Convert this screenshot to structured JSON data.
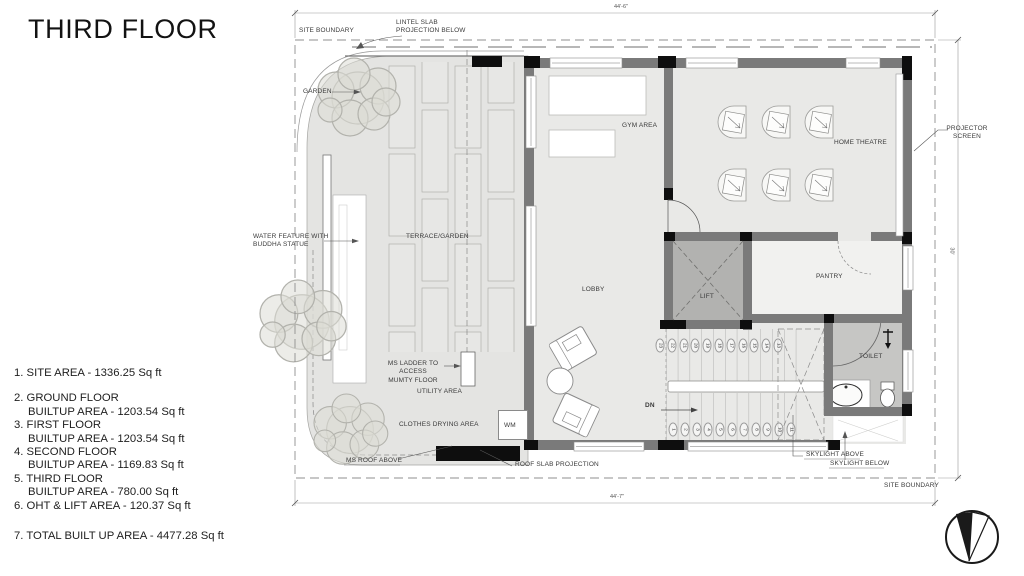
{
  "title": "THIRD FLOOR",
  "area_summary": {
    "items": [
      {
        "line1": "1. SITE AREA -  1336.25 Sq ft",
        "line2": ""
      },
      {
        "line1": "2. GROUND FLOOR",
        "line2": "BUILTUP AREA - 1203.54 Sq ft"
      },
      {
        "line1": "3. FIRST FLOOR",
        "line2": "BUILTUP AREA - 1203.54 Sq ft"
      },
      {
        "line1": "4. SECOND FLOOR",
        "line2": "BUILTUP AREA - 1169.83 Sq ft"
      },
      {
        "line1": "5. THIRD FLOOR",
        "line2": "BUILTUP AREA - 780.00 Sq ft"
      },
      {
        "line1": "6. OHT & LIFT AREA - 120.37 Sq ft",
        "line2": ""
      }
    ],
    "total": "7. TOTAL BUILT UP AREA -  4477.28 Sq ft"
  },
  "rooms": {
    "terrace": "TERRACE/GARDEN",
    "gym": "GYM AREA",
    "home_theatre": "HOME THEATRE",
    "lobby": "LOBBY",
    "lift": "LIFT",
    "pantry": "PANTRY",
    "toilet": "TOILET",
    "utility": "UTILITY AREA"
  },
  "annotations": {
    "site_boundary_top": "SITE BOUNDARY",
    "site_boundary_bottom": "SITE BOUNDARY",
    "lintel_slab": "LINTEL SLAB\nPROJECTION BELOW",
    "garden": "GARDEN",
    "water_feature": "WATER FEATURE WITH\nBUDDHA STATUE",
    "ms_ladder": "MS LADDER TO ACCESS\nMUMTY FLOOR",
    "clothes_drying": "CLOTHES DRYING AREA",
    "wm": "WM",
    "ms_roof": "MS ROOF ABOVE",
    "roof_slab": "ROOF SLAB PROJECTION",
    "skylight_above": "SKYLIGHT ABOVE",
    "skylight_below": "SKYLIGHT BELOW",
    "projector_screen": "PROJECTOR\nSCREEN"
  },
  "dimensions": {
    "top": "44'-6\"",
    "bottom": "44'-7\"",
    "right": "30'"
  },
  "stairs": {
    "upper_numbers": [
      "23",
      "22",
      "21",
      "20",
      "19",
      "18",
      "17",
      "16",
      "15",
      "14",
      "13"
    ],
    "lower_numbers": [
      "1",
      "2",
      "3",
      "4",
      "5",
      "6",
      "7",
      "8",
      "9",
      "10",
      "11"
    ],
    "down_label": "DN"
  },
  "colors": {
    "terrace_fill": "#e4e4e2",
    "room_fill": "#e9e9e7",
    "wall": "#7a7a7a",
    "lift_fill": "#b2b2b0",
    "toilet_fill": "#c6c6c4",
    "pantry_fill": "#f1f1ef",
    "column": "#0e0e0e",
    "boundary_line": "#8f8f8f",
    "ink": "#1a1a1a"
  }
}
